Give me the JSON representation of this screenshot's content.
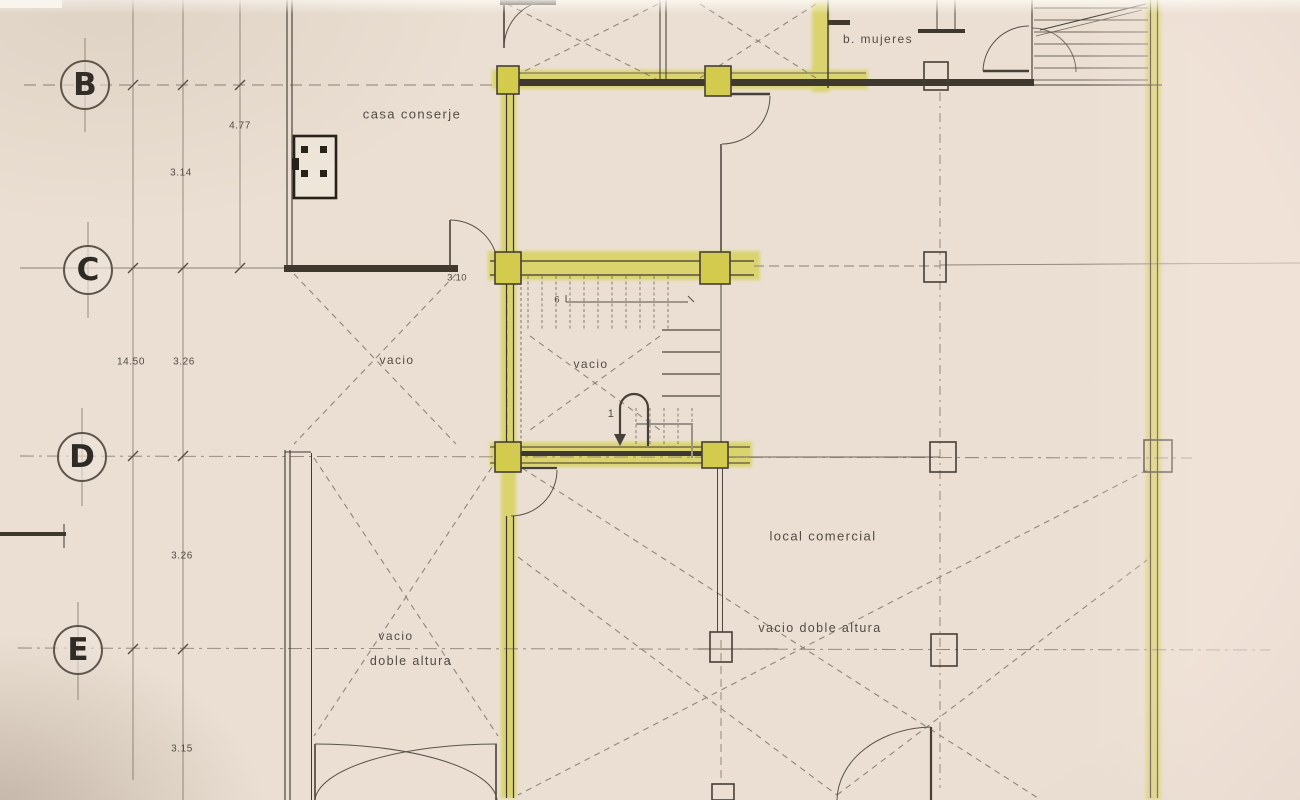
{
  "document": {
    "type": "architectural floor plan (scanned)",
    "language": "es"
  },
  "colors": {
    "paper": "#eadfd2",
    "ink_dark": "#3e382f",
    "line_light": "#8b8173",
    "highlighter_yellow": "#d6d052"
  },
  "grid": {
    "rows": [
      {
        "label": "B"
      },
      {
        "label": "C"
      },
      {
        "label": "D"
      },
      {
        "label": "E"
      }
    ]
  },
  "rooms": {
    "casa_conserje": "casa conserje",
    "bano_mujeres": "b. mujeres",
    "vacio_left": "vacio",
    "vacio_stair": "vacio",
    "local_comercial": "local comercial",
    "vacio_doble_altura": "vacio doble altura",
    "vacio_left_lower_1": "vacio",
    "vacio_left_lower_2": "doble altura"
  },
  "dimensions": {
    "d477": "4.77",
    "d314": "3.14",
    "d1450": "14.50",
    "d326a": "3.26",
    "d326b": "3.26",
    "d315": "3.15",
    "d310": "3.10"
  },
  "stairs": {
    "step_top": "6",
    "step_bottom": "1"
  }
}
